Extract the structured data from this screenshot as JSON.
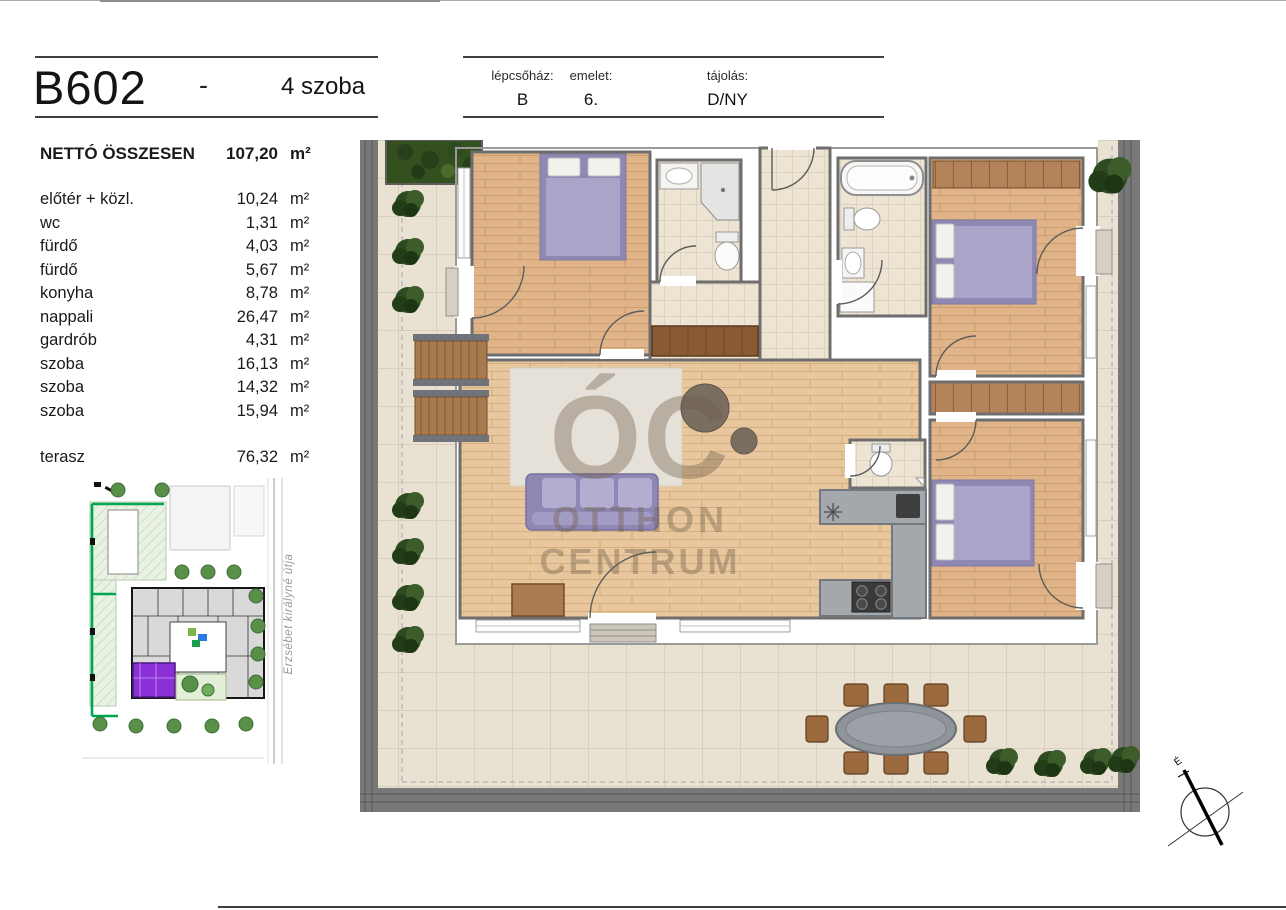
{
  "page": {
    "title_unit": "B602",
    "separator": "-",
    "rooms_label": "4 szoba"
  },
  "header_fields": [
    {
      "label": "lépcsőház:",
      "value": "B"
    },
    {
      "label": "emelet:",
      "value": "6."
    },
    {
      "label": "tájolás:",
      "value": "D/NY"
    }
  ],
  "area_table": {
    "total_label": "NETTÓ ÖSSZESEN",
    "total_value": "107,20",
    "unit": "m²",
    "rows": [
      {
        "label": "előtér + közl.",
        "value": "10,24"
      },
      {
        "label": "wc",
        "value": "1,31"
      },
      {
        "label": "fürdő",
        "value": "4,03"
      },
      {
        "label": "fürdő",
        "value": "5,67"
      },
      {
        "label": "konyha",
        "value": "8,78"
      },
      {
        "label": "nappali",
        "value": "26,47"
      },
      {
        "label": "gardrób",
        "value": "4,31"
      },
      {
        "label": "szoba",
        "value": "16,13"
      },
      {
        "label": "szoba",
        "value": "14,32"
      },
      {
        "label": "szoba",
        "value": "15,94"
      }
    ],
    "terrace_row": {
      "label": "terasz",
      "value": "76,32"
    }
  },
  "site_map": {
    "street_name": "Erzsébet királyné útja",
    "highlight_color": "#8b2fd6",
    "boundary_color": "#00a651"
  },
  "floor_plan": {
    "watermark_top": "ÓC",
    "watermark_line1": "OTTHON",
    "watermark_line2": "CENTRUM",
    "compass_label": "É"
  },
  "colors": {
    "accent_purple": "#8b2fd6",
    "bed_purple": "#a8a2c9",
    "terrace_tile": "#e9e1d2",
    "wood_floor": "#e0b488",
    "railing_gray": "#787878"
  }
}
